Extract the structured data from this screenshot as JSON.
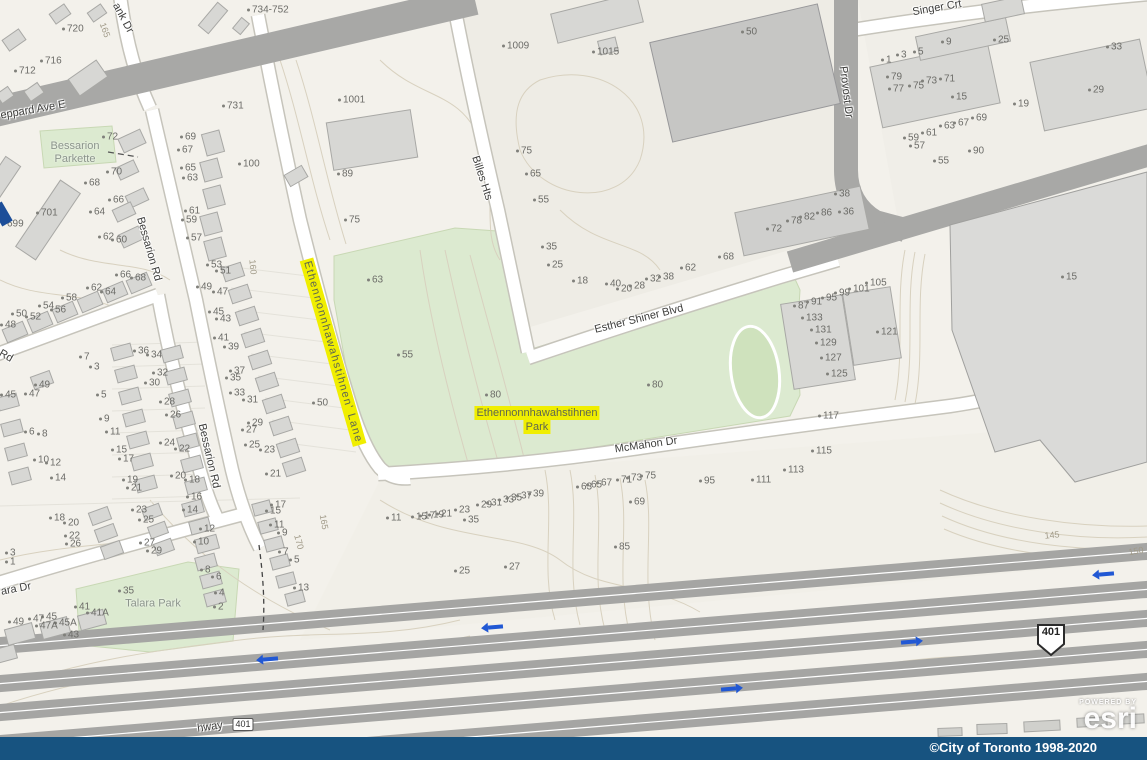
{
  "map": {
    "colors": {
      "highlight_yellow": "#f0ee00",
      "park_green": "#dcead0",
      "road_gray": "#a8a8a6",
      "building_gray": "#d7d7d4",
      "contour_tan": "#d8d1bf",
      "footer_blue": "#175380",
      "arrow_blue": "#2158d4"
    },
    "street_labels": [
      [
        "eppard Ave E",
        33,
        110,
        -10
      ],
      [
        "ank Dr",
        123,
        18,
        62
      ],
      [
        "Bessarion Rd",
        149,
        249,
        74
      ],
      [
        "Bessarion Rd",
        209,
        456,
        77
      ],
      [
        "Billes Hts",
        482,
        178,
        72
      ],
      [
        "Singer Crt",
        937,
        8,
        -10
      ],
      [
        "Provost Dr",
        846,
        92,
        83
      ],
      [
        "Esther Shiner Blvd",
        639,
        319,
        -14
      ],
      [
        "McMahon Dr",
        646,
        445,
        -8
      ],
      [
        "ara Dr",
        16,
        589,
        -11
      ],
      [
        "Rd",
        6,
        356,
        30
      ],
      [
        "hway",
        210,
        727,
        -8
      ]
    ],
    "highlight_labels": {
      "lane": {
        "text": "Ethennonnhawahstihnen' Lane",
        "x": 333,
        "y": 352,
        "rot": 74
      },
      "park": {
        "lines": [
          "Ethennonnhawahstihnen",
          "Park"
        ],
        "x": 537,
        "y": 420
      }
    },
    "park_labels": [
      {
        "lines": [
          "Bessarion",
          "Parkette"
        ],
        "x": 75,
        "y": 153
      },
      {
        "lines": [
          "Talara Park"
        ],
        "x": 153,
        "y": 604
      }
    ],
    "contour_labels": [
      [
        "165",
        105,
        30,
        70
      ],
      [
        "160",
        253,
        267,
        85
      ],
      [
        "165",
        324,
        522,
        80
      ],
      [
        "170",
        299,
        542,
        75
      ],
      [
        "145",
        1052,
        535,
        -6
      ],
      [
        "150",
        1136,
        551,
        -10
      ]
    ],
    "address_labels": [
      [
        "734-752",
        247,
        10
      ],
      [
        "720",
        62,
        29
      ],
      [
        "716",
        40,
        61
      ],
      [
        "712",
        14,
        71
      ],
      [
        "1001",
        338,
        100
      ],
      [
        "1009",
        502,
        46
      ],
      [
        "1015",
        592,
        52
      ],
      [
        "50",
        741,
        32
      ],
      [
        "731",
        222,
        106
      ],
      [
        "100",
        238,
        164
      ],
      [
        "89",
        337,
        174
      ],
      [
        "75",
        344,
        220
      ],
      [
        "72",
        102,
        137
      ],
      [
        "70",
        106,
        172
      ],
      [
        "68",
        84,
        183
      ],
      [
        "66",
        108,
        200
      ],
      [
        "64",
        89,
        212
      ],
      [
        "62",
        98,
        237
      ],
      [
        "60",
        111,
        240
      ],
      [
        "701",
        36,
        213
      ],
      [
        "699",
        2,
        224
      ],
      [
        "69",
        180,
        137
      ],
      [
        "67",
        177,
        150
      ],
      [
        "65",
        180,
        168
      ],
      [
        "63",
        182,
        178
      ],
      [
        "61",
        184,
        211
      ],
      [
        "59",
        181,
        220
      ],
      [
        "57",
        186,
        238
      ],
      [
        "75",
        516,
        151
      ],
      [
        "65",
        525,
        174
      ],
      [
        "55",
        533,
        200
      ],
      [
        "35",
        541,
        247
      ],
      [
        "25",
        547,
        265
      ],
      [
        "18",
        572,
        281
      ],
      [
        "40",
        605,
        284
      ],
      [
        "20",
        616,
        289
      ],
      [
        "28",
        629,
        286
      ],
      [
        "32",
        645,
        279
      ],
      [
        "38",
        658,
        277
      ],
      [
        "62",
        680,
        268
      ],
      [
        "68",
        718,
        257
      ],
      [
        "9",
        941,
        42
      ],
      [
        "25",
        993,
        40
      ],
      [
        "1",
        881,
        60
      ],
      [
        "3",
        896,
        55
      ],
      [
        "5",
        913,
        52
      ],
      [
        "33",
        1106,
        47
      ],
      [
        "79",
        886,
        77
      ],
      [
        "77",
        888,
        89
      ],
      [
        "75",
        908,
        86
      ],
      [
        "73",
        921,
        81
      ],
      [
        "71",
        939,
        79
      ],
      [
        "15",
        951,
        97
      ],
      [
        "19",
        1013,
        104
      ],
      [
        "29",
        1088,
        90
      ],
      [
        "63",
        939,
        126
      ],
      [
        "67",
        953,
        123
      ],
      [
        "69",
        971,
        118
      ],
      [
        "59",
        903,
        138
      ],
      [
        "61",
        921,
        133
      ],
      [
        "57",
        909,
        146
      ],
      [
        "55",
        933,
        161
      ],
      [
        "90",
        968,
        151
      ],
      [
        "38",
        834,
        194
      ],
      [
        "72",
        766,
        229
      ],
      [
        "78",
        786,
        221
      ],
      [
        "82",
        799,
        217
      ],
      [
        "86",
        816,
        213
      ],
      [
        "36",
        838,
        212
      ],
      [
        "66",
        115,
        275
      ],
      [
        "68",
        130,
        278
      ],
      [
        "62",
        86,
        288
      ],
      [
        "64",
        100,
        292
      ],
      [
        "58",
        61,
        298
      ],
      [
        "54",
        38,
        306
      ],
      [
        "56",
        50,
        310
      ],
      [
        "50",
        11,
        314
      ],
      [
        "52",
        25,
        317
      ],
      [
        "48",
        0,
        325
      ],
      [
        "53",
        206,
        265
      ],
      [
        "51",
        215,
        271
      ],
      [
        "49",
        196,
        287
      ],
      [
        "47",
        212,
        292
      ],
      [
        "45",
        208,
        312
      ],
      [
        "43",
        215,
        319
      ],
      [
        "41",
        213,
        338
      ],
      [
        "39",
        223,
        347
      ],
      [
        "37",
        229,
        371
      ],
      [
        "35",
        225,
        378
      ],
      [
        "33",
        229,
        393
      ],
      [
        "31",
        242,
        400
      ],
      [
        "29",
        247,
        423
      ],
      [
        "27",
        241,
        430
      ],
      [
        "25",
        244,
        445
      ],
      [
        "23",
        259,
        450
      ],
      [
        "21",
        265,
        474
      ],
      [
        "7",
        79,
        357
      ],
      [
        "3",
        89,
        367
      ],
      [
        "5",
        96,
        395
      ],
      [
        "9",
        99,
        419
      ],
      [
        "11",
        105,
        432
      ],
      [
        "15",
        111,
        450
      ],
      [
        "17",
        118,
        459
      ],
      [
        "19",
        122,
        480
      ],
      [
        "21",
        126,
        488
      ],
      [
        "36",
        133,
        351
      ],
      [
        "34",
        146,
        355
      ],
      [
        "32",
        152,
        373
      ],
      [
        "30",
        144,
        383
      ],
      [
        "28",
        159,
        402
      ],
      [
        "26",
        165,
        415
      ],
      [
        "24",
        159,
        443
      ],
      [
        "22",
        174,
        449
      ],
      [
        "20",
        170,
        476
      ],
      [
        "18",
        184,
        480
      ],
      [
        "16",
        186,
        497
      ],
      [
        "49",
        34,
        385
      ],
      [
        "47",
        24,
        394
      ],
      [
        "45",
        0,
        395
      ],
      [
        "6",
        24,
        432
      ],
      [
        "8",
        37,
        434
      ],
      [
        "10",
        33,
        460
      ],
      [
        "12",
        45,
        463
      ],
      [
        "14",
        50,
        478
      ],
      [
        "18",
        49,
        518
      ],
      [
        "20",
        63,
        523
      ],
      [
        "22",
        64,
        536
      ],
      [
        "26",
        65,
        544
      ],
      [
        "3",
        5,
        553
      ],
      [
        "1",
        5,
        562
      ],
      [
        "63",
        367,
        280
      ],
      [
        "55",
        397,
        355
      ],
      [
        "80",
        485,
        395
      ],
      [
        "80",
        647,
        385
      ],
      [
        "50",
        312,
        403
      ],
      [
        "23",
        131,
        510
      ],
      [
        "25",
        138,
        520
      ],
      [
        "27",
        139,
        543
      ],
      [
        "29",
        146,
        551
      ],
      [
        "14",
        182,
        510
      ],
      [
        "12",
        199,
        529
      ],
      [
        "10",
        193,
        542
      ],
      [
        "8",
        200,
        570
      ],
      [
        "6",
        211,
        577
      ],
      [
        "4",
        214,
        593
      ],
      [
        "2",
        213,
        607
      ],
      [
        "17",
        270,
        505
      ],
      [
        "15",
        265,
        511
      ],
      [
        "11",
        269,
        525
      ],
      [
        "9",
        277,
        533
      ],
      [
        "7",
        278,
        552
      ],
      [
        "5",
        289,
        560
      ],
      [
        "13",
        293,
        588
      ],
      [
        "35",
        118,
        591
      ],
      [
        "41",
        74,
        607
      ],
      [
        "41A",
        86,
        613
      ],
      [
        "45A",
        54,
        623
      ],
      [
        "47A",
        35,
        626
      ],
      [
        "43",
        63,
        635
      ],
      [
        "45",
        41,
        617
      ],
      [
        "47",
        28,
        619
      ],
      [
        "49",
        8,
        622
      ],
      [
        "11",
        386,
        518
      ],
      [
        "15",
        411,
        517
      ],
      [
        "17",
        419,
        516
      ],
      [
        "19",
        428,
        515
      ],
      [
        "21",
        436,
        514
      ],
      [
        "23",
        454,
        510
      ],
      [
        "29",
        476,
        505
      ],
      [
        "31",
        486,
        503
      ],
      [
        "33",
        498,
        500
      ],
      [
        "35",
        506,
        498
      ],
      [
        "37",
        516,
        496
      ],
      [
        "39",
        528,
        494
      ],
      [
        "35",
        463,
        520
      ],
      [
        "63",
        576,
        487
      ],
      [
        "65",
        586,
        485
      ],
      [
        "67",
        596,
        483
      ],
      [
        "71",
        616,
        480
      ],
      [
        "73",
        626,
        478
      ],
      [
        "75",
        640,
        476
      ],
      [
        "69",
        629,
        502
      ],
      [
        "85",
        614,
        547
      ],
      [
        "95",
        699,
        481
      ],
      [
        "111",
        751,
        480
      ],
      [
        "113",
        783,
        470
      ],
      [
        "115",
        811,
        451
      ],
      [
        "117",
        818,
        416
      ],
      [
        "25",
        454,
        571
      ],
      [
        "27",
        504,
        567
      ],
      [
        "87",
        793,
        306
      ],
      [
        "91",
        806,
        302
      ],
      [
        "95",
        821,
        298
      ],
      [
        "99",
        834,
        293
      ],
      [
        "101",
        848,
        289
      ],
      [
        "105",
        865,
        283
      ],
      [
        "133",
        801,
        318
      ],
      [
        "131",
        810,
        330
      ],
      [
        "129",
        815,
        343
      ],
      [
        "127",
        820,
        358
      ],
      [
        "125",
        826,
        374
      ],
      [
        "121",
        876,
        332
      ],
      [
        "15",
        1061,
        277
      ]
    ],
    "highway_shields": [
      {
        "text": "401",
        "x": 1051,
        "y": 640,
        "style": "crown"
      },
      {
        "text": "401",
        "x": 243,
        "y": 723,
        "style": "box"
      }
    ],
    "arrows": [
      {
        "x": 263,
        "y": 657,
        "dir": "left"
      },
      {
        "x": 488,
        "y": 625,
        "dir": "left"
      },
      {
        "x": 721,
        "y": 687,
        "dir": "right"
      },
      {
        "x": 901,
        "y": 640,
        "dir": "right"
      },
      {
        "x": 1099,
        "y": 572,
        "dir": "left"
      }
    ],
    "watermark": {
      "line1": "POWERED BY",
      "brand": "esri"
    },
    "footer": {
      "text": "©City of Toronto 1998-2020"
    }
  }
}
